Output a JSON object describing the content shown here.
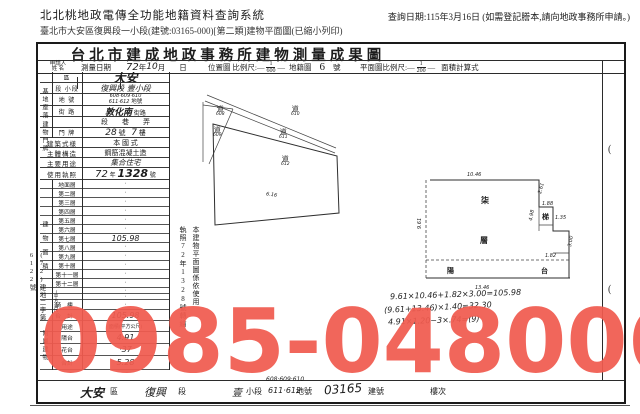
{
  "page": {
    "system_title": "北北桃地政電傳全功能地籍資料查詢系統",
    "query_note": "查詢日期:115年3月16日 (如需登記謄本,請向地政事務所申請。)",
    "doc_line": "臺北市大安區復興段一小段(建號:03165-000)[第二類]建物平面圖(已縮小列印)"
  },
  "watermark": {
    "text": "0985-048006",
    "color": "#f15b4f"
  },
  "form": {
    "title": "台北市建成地政事務所建物測量成果圖",
    "header": {
      "applicant_line1": "申請人",
      "applicant_line2": "姓 名",
      "survey_label": "測量日期",
      "survey_year": "72",
      "survey_year_unit": "年",
      "survey_month": "10",
      "survey_month_unit": "月",
      "survey_day_unit": "日",
      "loc_label": "位置圖  比例尺:",
      "loc_num": "1",
      "loc_den": "600",
      "cad_label": "地籍圖",
      "cad_no": "6",
      "cad_unit": "號",
      "plan_label": "平面圖比例尺:",
      "plan_num": "1",
      "plan_den": "200",
      "calc_label": "面積計算式"
    },
    "site": {
      "group_label": "基地座落",
      "district_label": "區",
      "district_value": "大安",
      "section_label": "段 小段",
      "section_value": "復興段 壹小段",
      "lot_label": "地 號",
      "lot_line1": "608·609·610",
      "lot_line2": "611·612",
      "lot_suffix": "地號"
    },
    "address": {
      "group_label": "建物門牌",
      "street_label": "街 路",
      "street_value": "敦化南",
      "street_suffix": "街路",
      "lane_row": "段　　巷　　弄",
      "door_label": "門 牌",
      "door_no": "28",
      "door_no_unit": "號",
      "door_floor": "7",
      "door_floor_unit": "樓"
    },
    "style_label": "建築式樣",
    "style_value": "本 國 式",
    "structure_label": "主體構造",
    "structure_value": "鋼筋混凝土造",
    "use_label": "主要用途",
    "use_value": "集合住宅",
    "license_label": "使用執照",
    "license_year": "72",
    "license_year_unit": "年",
    "license_no": "1328",
    "license_no_unit": "號",
    "floors": {
      "group_label": "建物面積",
      "unit_label": "(平方公尺)",
      "rows": [
        {
          "label": "地面層",
          "value": "·"
        },
        {
          "label": "第二層",
          "value": "·"
        },
        {
          "label": "第三層",
          "value": "·"
        },
        {
          "label": "第四層",
          "value": "·"
        },
        {
          "label": "第五層",
          "value": "·"
        },
        {
          "label": "第六層",
          "value": "·"
        },
        {
          "label": "第七層",
          "value": "105.98",
          "hw": true
        },
        {
          "label": "第八層",
          "value": "·"
        },
        {
          "label": "第九層",
          "value": "·"
        },
        {
          "label": "第十層",
          "value": "·"
        },
        {
          "label": "第十一層",
          "value": "·"
        },
        {
          "label": "第十二層",
          "value": "·"
        }
      ],
      "blank_rows": [
        "·",
        "·"
      ],
      "qilou_label": "騎樓",
      "qilou_value": "·",
      "total_label": "合計",
      "total_value": "105.98"
    },
    "attached": {
      "group_label": "附屬建物",
      "use_header": "用途",
      "area_header": "面積(平方公尺)",
      "rows": [
        {
          "label": "陽台",
          "value": "4.91"
        },
        {
          "label": "花台",
          "value": "·37"
        },
        {
          "label": "合計",
          "value": "5.28"
        }
      ]
    },
    "notes": {
      "line1": "本建物平面圖係依使用",
      "line2": "執照72年1328號轉繪"
    },
    "margin_note": "(72)建地二字第6122號",
    "calc_lines": [
      "9.61×10.46+1.82×3.00=105.98",
      "(9.61+13.46)×1.40=32.30",
      "4.91×1.20−3×.74=(9)"
    ],
    "map": {
      "road_char": "道",
      "labels": [
        {
          "char": "道",
          "num": "608"
        },
        {
          "char": "道",
          "num": "609"
        },
        {
          "char": "道",
          "num": "610"
        },
        {
          "char": "道",
          "num": "611"
        },
        {
          "char": "道",
          "num": "612"
        }
      ],
      "dim": "6.16"
    },
    "plan": {
      "dim_top": "10.46",
      "dim_bottom": "13.46",
      "dim_left": "9.61",
      "dim_r1": "2.61",
      "dim_r2": "1.88",
      "dim_r3": "4.98",
      "dim_r4": "1.35",
      "dim_r5": "3.00",
      "dim_r6": "1.82",
      "room_a": "柒",
      "room_b": "層",
      "stair": "梯",
      "balcony_l": "陽",
      "balcony_r": "台"
    },
    "right_col": {
      "mark1": "(",
      "mark2": "("
    },
    "footer": {
      "district": "大安",
      "district_unit": "區",
      "section": "復興",
      "section_unit": "段",
      "subsection": "壹",
      "subsection_unit": "小段",
      "lots_above": "608·609·610",
      "lots": "611·612",
      "lots_unit": "地號",
      "building_no": "03165",
      "building_unit": "建號",
      "floor_label": "樓次"
    }
  }
}
